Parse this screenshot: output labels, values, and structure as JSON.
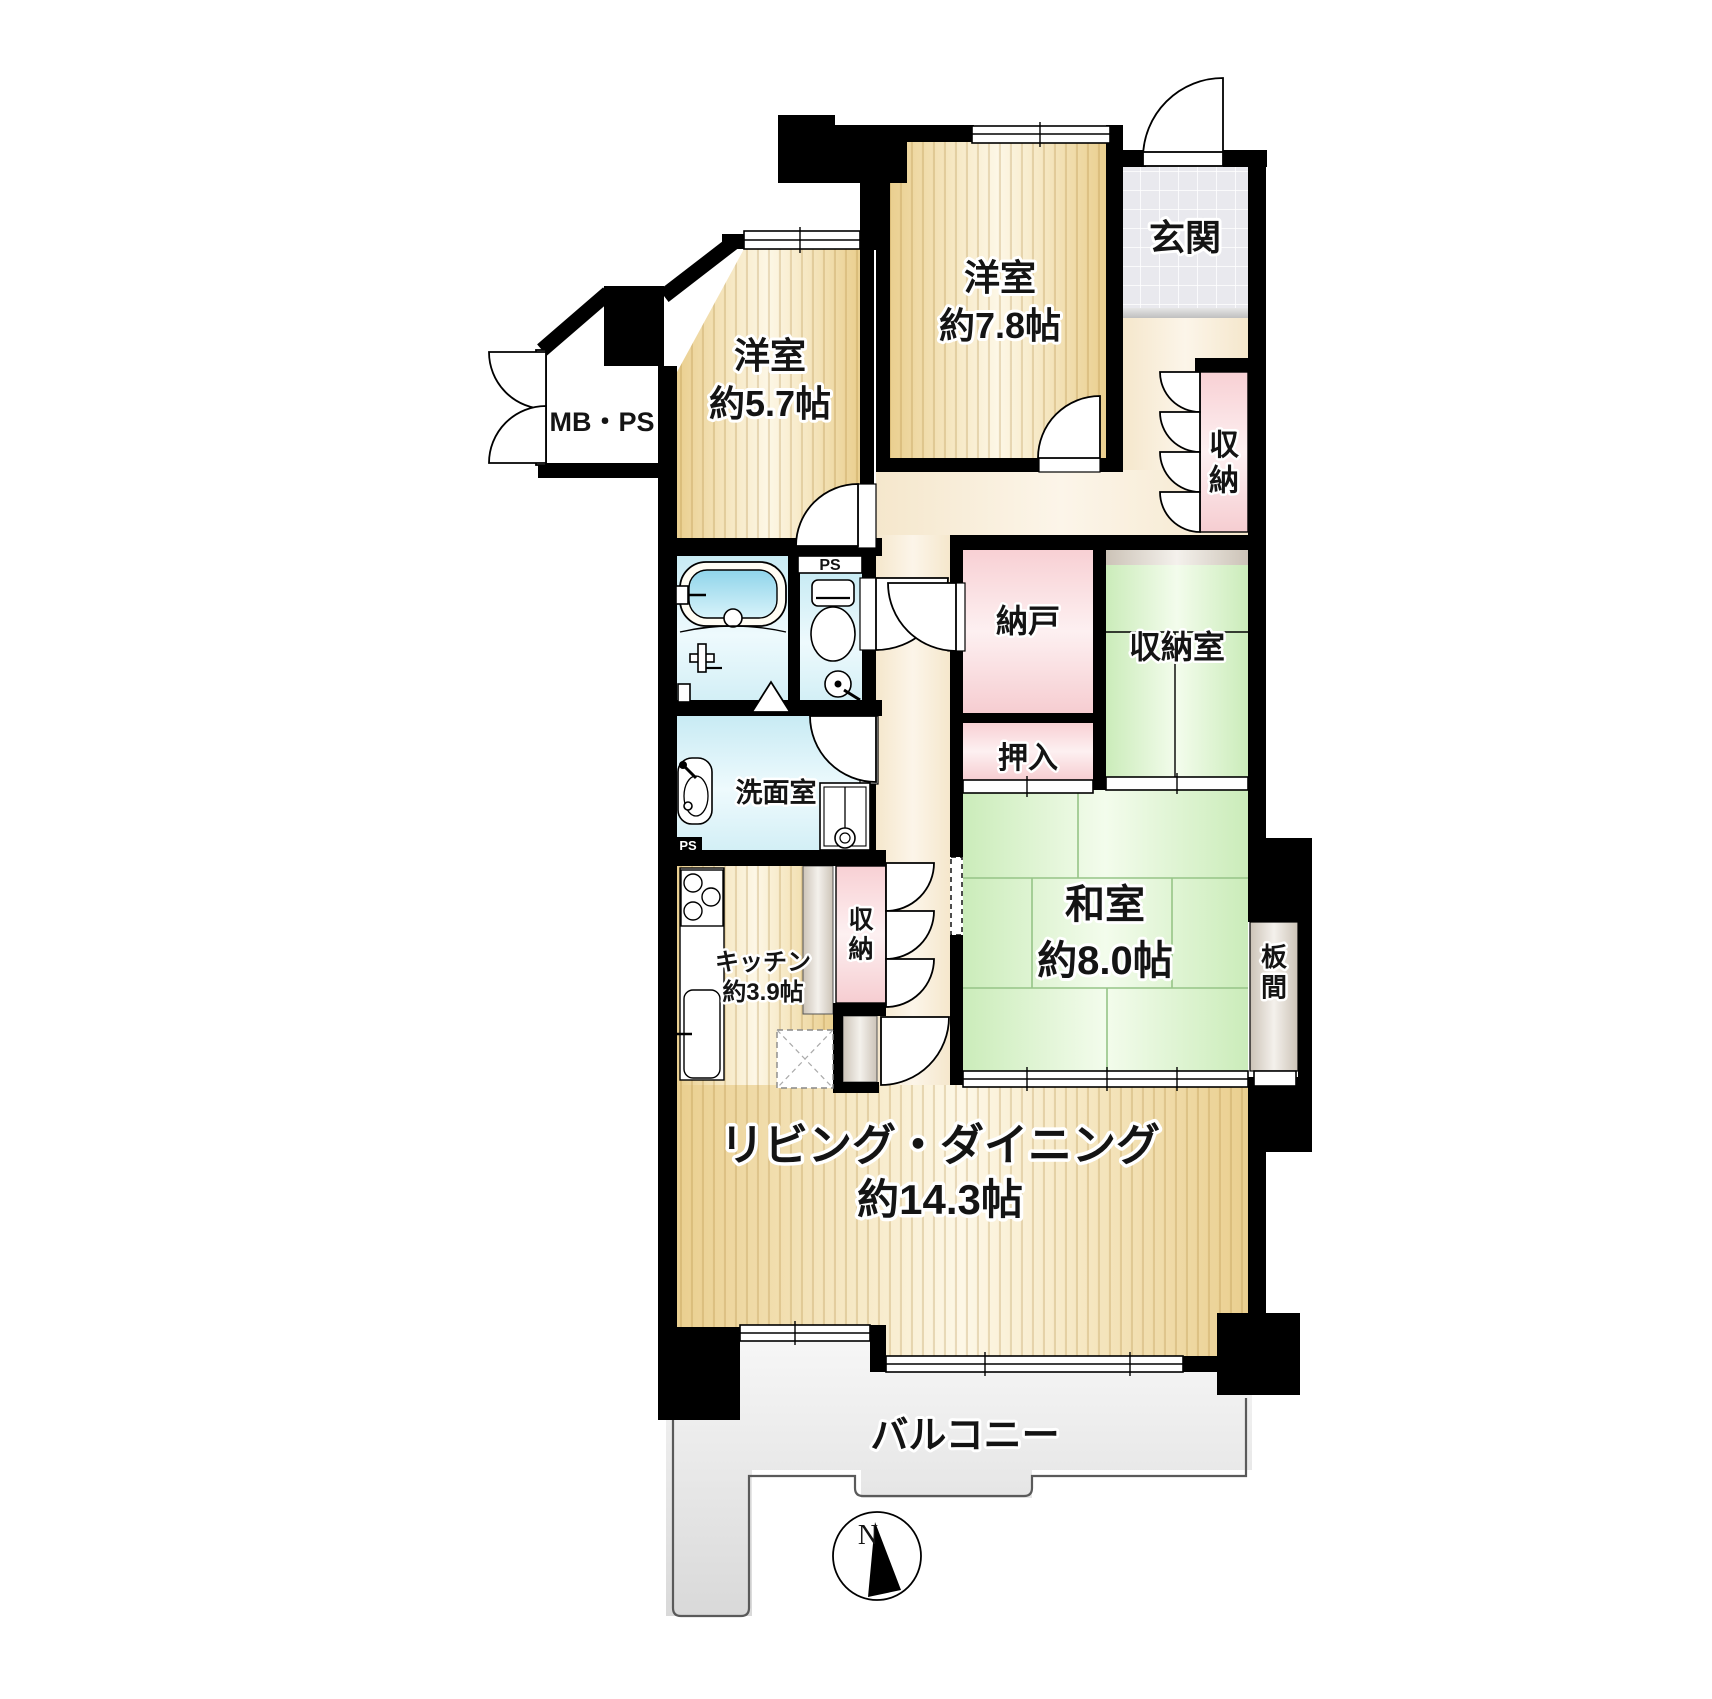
{
  "plan": {
    "compass_north": "N",
    "rooms": {
      "genkan": {
        "label": "玄関"
      },
      "western_room_78": {
        "label": "洋室",
        "size": "約7.8帖"
      },
      "western_room_57": {
        "label": "洋室",
        "size": "約5.7帖"
      },
      "mb_ps": {
        "label": "MB・PS"
      },
      "hall_closet": {
        "label": "収納"
      },
      "nando": {
        "label": "納戸"
      },
      "shunoshitsu": {
        "label": "収納室"
      },
      "oshiire": {
        "label": "押入"
      },
      "washitsu": {
        "label": "和室",
        "size": "約8.0帖"
      },
      "itanoma": {
        "label": "板間"
      },
      "senmenshitsu": {
        "label": "洗面室"
      },
      "kitchen": {
        "label": "キッチン",
        "size": "約3.9帖"
      },
      "kitchen_closet": {
        "label": "収納"
      },
      "living_dining": {
        "label": "リビング・ダイニング",
        "size": "約14.3帖"
      },
      "balcony": {
        "label": "バルコニー"
      },
      "toilet_ps": {
        "label": "PS"
      },
      "kitchen_ps": {
        "label": "PS"
      }
    },
    "palette": {
      "wall": "#000000",
      "wood_floor_edge": "#ecd193",
      "wood_floor_center": "#fdf7e6",
      "tatami_green": "#d5efc6",
      "closet_pink": "#f8d4d7",
      "bath_cyan": "#cdedf5",
      "hall_cream": "#f6e9d0",
      "tile_gray": "#e9e9ee",
      "balcony_gray": "#e3e3e3",
      "wood_deck_gray": "#d2cabf",
      "bath_water_blue": "#9fdbee"
    }
  }
}
